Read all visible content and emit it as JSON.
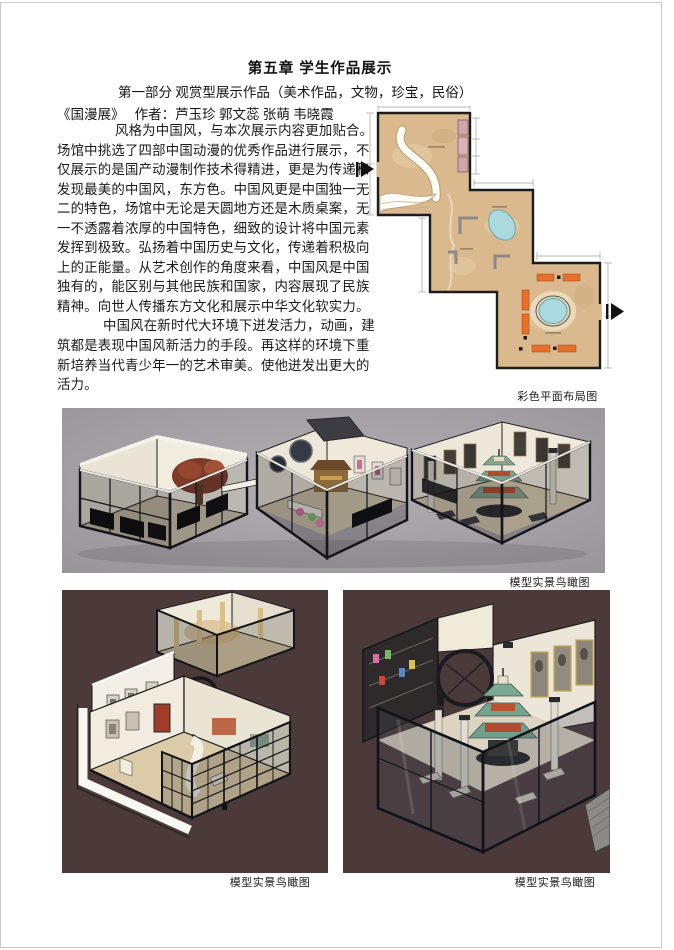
{
  "page": {
    "title": "第五章 学生作品展示",
    "subtitle": "第一部分  观赏型展示作品（美术作品，文物，珍宝，民俗）",
    "work_line": "《国漫展》　 作者：芦玉珍 郭文蕊 张萌 韦晓霞"
  },
  "body": {
    "lines": [
      "风格为中国风，与本次展示内容更加贴合。",
      "场馆中挑选了四部中国动漫的优秀作品进行展示，不",
      "仅展示的是国产动漫制作技术得精进，更是为传递和",
      "发现最美的中国风，东方色。中国风更是中国独一无",
      "二的特色，场馆中无论是天圆地方还是木质桌案，无",
      "一不透露着浓厚的中国特色，细致的设计将中国元素",
      "发挥到极致。弘扬着中国历史与文化，传递着积极向",
      "上的正能量。从艺术创作的角度来看，中国风是中国",
      "独有的，能区别与其他民族和国家，内容展现了民族",
      "精神。向世人传播东方文化和展示中华文化软实力。",
      "中国风在新时代大环境下迸发活力，动画，建",
      "筑都是表现中国风新活力的手段。再这样的环境下重",
      "新培养当代青少年一的艺术审美。使他迸发出更大的",
      "活力。"
    ]
  },
  "figures": {
    "floor_plan_caption": "彩色平面布局图",
    "model_wide_caption": "模型实景鸟瞰图",
    "model_left_caption": "模型实景鸟瞰图",
    "model_right_caption": "模型实景鸟瞰图"
  },
  "colors": {
    "floor_tan": "#d9b98d",
    "pond_blue": "#abdade",
    "bench_orange": "#e4702c",
    "display_case_pink": "#cfa6aa",
    "wall_black": "#17171a",
    "model_bg_gray": "#a29ea4",
    "model_bg_maroon": "#4c3a3b",
    "pagoda_green": "#74a390",
    "pagoda_red": "#b14a2e"
  }
}
